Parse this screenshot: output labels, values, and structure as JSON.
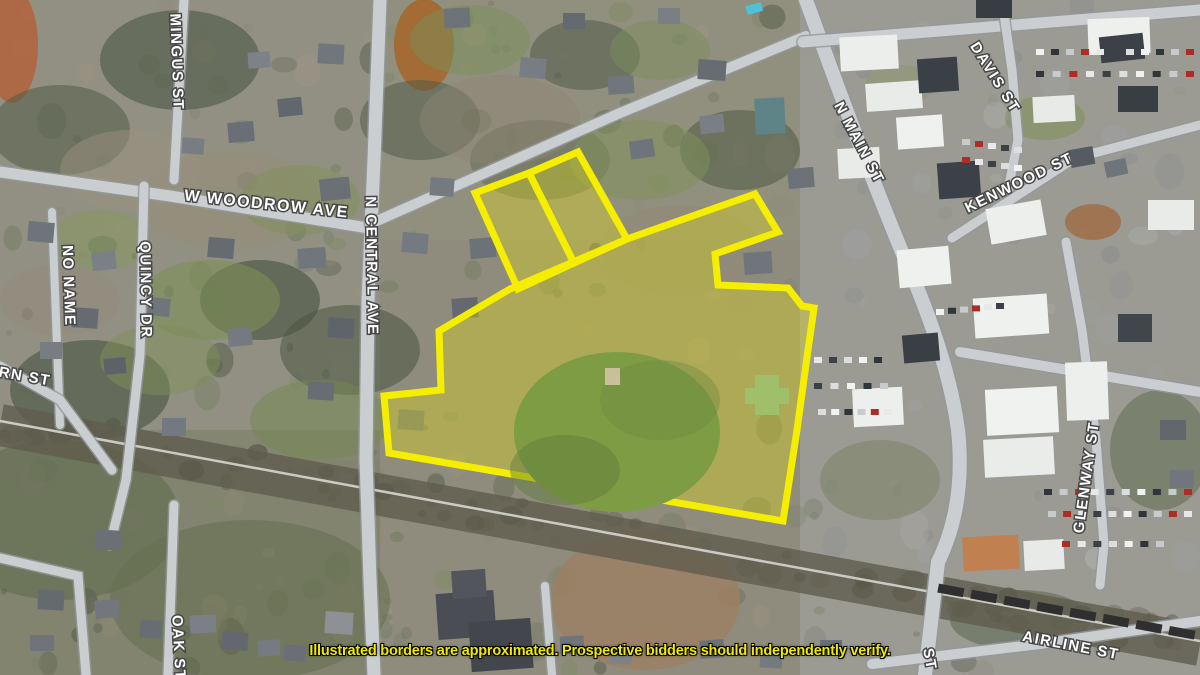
{
  "image_type": "aerial-satellite-photo",
  "disclaimer": "Illustrated borders are approximated. Prospective bidders should independently verify.",
  "colors": {
    "boundary_yellow": "#f5ee00",
    "boundary_fill_opacity": 0.3,
    "disclaimer_yellow": "#f2ea00",
    "label_white": "#ffffff",
    "label_outline": "#474747",
    "pond_green": "#7e9c44",
    "road_gray": "#cbced0",
    "railroad_band": "#5f5d4e"
  },
  "street_labels": [
    {
      "name": "mingus-st",
      "text": "MINGUS ST",
      "x": 172,
      "y": 62,
      "rotate": 88,
      "size": 15
    },
    {
      "name": "w-woodrow-ave",
      "text": "W WOODROW AVE",
      "x": 266,
      "y": 209,
      "rotate": 6,
      "size": 16
    },
    {
      "name": "n-central-ave",
      "text": "N CENTRAL AVE",
      "x": 367,
      "y": 266,
      "rotate": 89,
      "size": 15
    },
    {
      "name": "no-name",
      "text": "NO NAME",
      "x": 64,
      "y": 286,
      "rotate": 88,
      "size": 15
    },
    {
      "name": "quincy-dr",
      "text": "QUINCY DR",
      "x": 141,
      "y": 290,
      "rotate": 89,
      "size": 15
    },
    {
      "name": "rn-st",
      "text": "RN ST",
      "x": 24,
      "y": 381,
      "rotate": 10,
      "size": 15
    },
    {
      "name": "n-main-st",
      "text": "N MAIN ST",
      "x": 855,
      "y": 145,
      "rotate": 62,
      "size": 15
    },
    {
      "name": "davis-st",
      "text": "DAVIS ST",
      "x": 991,
      "y": 80,
      "rotate": 58,
      "size": 15
    },
    {
      "name": "kenwood-st",
      "text": "KENWOOD ST",
      "x": 1021,
      "y": 187,
      "rotate": -26,
      "size": 15
    },
    {
      "name": "glenway-st",
      "text": "GLENWAY ST",
      "x": 1091,
      "y": 478,
      "rotate": -82,
      "size": 15
    },
    {
      "name": "airline-st",
      "text": "AIRLINE ST",
      "x": 1070,
      "y": 650,
      "rotate": 11,
      "size": 15
    },
    {
      "name": "oak-st",
      "text": "OAK ST",
      "x": 174,
      "y": 648,
      "rotate": 87,
      "size": 15
    },
    {
      "name": "st-partial",
      "text": "ST",
      "x": 925,
      "y": 660,
      "rotate": 80,
      "size": 15
    }
  ],
  "roads": [
    {
      "name": "n-central-ave",
      "d": "M380,0 L374,160 L368,300 L366,460 L370,580 L374,675",
      "w": 13
    },
    {
      "name": "w-woodrow-ave",
      "d": "M0,172 L170,196 L368,228",
      "w": 11
    },
    {
      "name": "woodrow-ave-ne",
      "d": "M370,224 L620,113 L806,36",
      "w": 10
    },
    {
      "name": "mingus-st",
      "d": "M184,0 L174,180",
      "w": 9
    },
    {
      "name": "no-name",
      "d": "M52,212 L60,425",
      "w": 8
    },
    {
      "name": "quincy-dr",
      "d": "M144,186 L140,355 L126,480 L110,545",
      "w": 9
    },
    {
      "name": "rn-st",
      "d": "M0,366 L60,400 L112,470",
      "w": 9
    },
    {
      "name": "oak-st",
      "d": "M174,505 L168,675",
      "w": 9
    },
    {
      "name": "bottom-left-st",
      "d": "M0,558 L78,576 L86,675",
      "w": 9
    },
    {
      "name": "n-main-st",
      "d": "M806,0 Q860,150 902,252 Q948,355 958,430 Q966,505 938,562 L925,675",
      "w": 14
    },
    {
      "name": "top-right-st",
      "d": "M803,42 L1200,10",
      "w": 11
    },
    {
      "name": "davis-st",
      "d": "M1002,0 L1012,70 L1018,140 L1008,190",
      "w": 9
    },
    {
      "name": "kenwood-st",
      "d": "M952,238 L1075,158 L1200,125",
      "w": 9
    },
    {
      "name": "glenway-st",
      "d": "M1066,242 L1082,330 L1096,440 L1104,545 L1100,585",
      "w": 9
    },
    {
      "name": "downtown-cross-st",
      "d": "M960,352 L1200,392",
      "w": 10
    },
    {
      "name": "airline-st",
      "d": "M872,664 L1040,644 L1200,621",
      "w": 10
    },
    {
      "name": "school-st",
      "d": "M545,586 L552,675",
      "w": 8
    }
  ],
  "railroad": {
    "band_d": "M0,425 L1200,645",
    "track_d": "M0,421 L380,491 L690,548 L1200,641",
    "band_width": 42
  },
  "parcel": {
    "main_points": "439,331 510,289 627,239 755,194 778,232 715,254 718,285 788,288 802,306 814,308 808,350 797,430 783,521 389,453 384,396 441,390",
    "small_parcel_left_points": "475,193 529,173 574,263 518,289",
    "small_parcel_right_points": "529,173 578,152 627,239 574,263"
  },
  "pond": {
    "cx": 617,
    "cy": 432,
    "rx": 103,
    "ry": 80
  }
}
